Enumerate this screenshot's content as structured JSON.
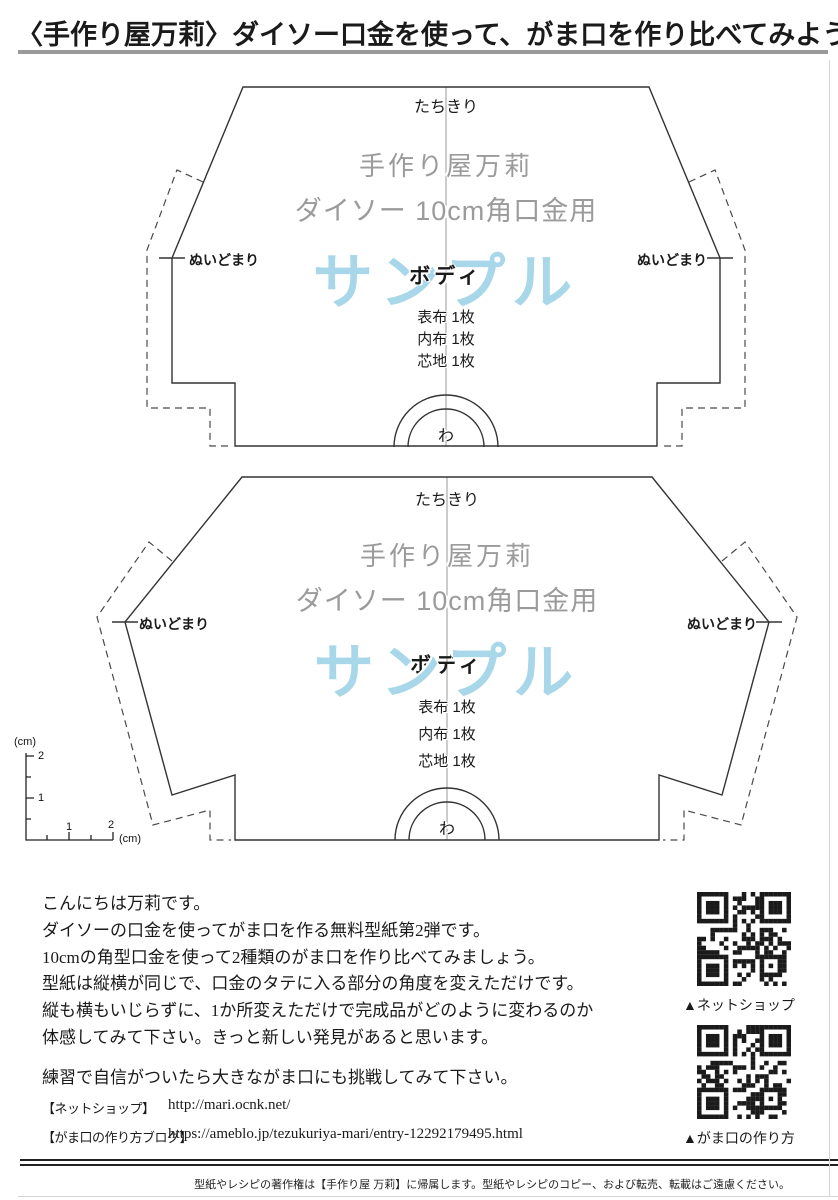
{
  "page": {
    "title": "〈手作り屋万莉〉ダイソー口金を使って、がま口を作り比べてみよう",
    "footer": "型紙やレシピの著作権は【手作り屋 万莉】に帰属します。型紙やレシピのコピー、および転売、転載はご遠慮ください。"
  },
  "colors": {
    "watermark_blue": "#a8d7ea",
    "gray_text": "#9b9b9b",
    "outline": "#333333"
  },
  "patterns": [
    {
      "cut_label": "たちきり",
      "brand": "手作り屋万莉",
      "frame": "ダイソー 10cm角口金用",
      "watermark": "サンプル",
      "piece": "ボディ",
      "materials": [
        "表布 1枚",
        "内布 1枚",
        "芯地 1枚"
      ],
      "fold_label": "わ",
      "seam_stop_left": "ぬいどまり",
      "seam_stop_right": "ぬいどまり"
    },
    {
      "cut_label": "たちきり",
      "brand": "手作り屋万莉",
      "frame": "ダイソー 10cm角口金用",
      "watermark": "サンプル",
      "piece": "ボディ",
      "materials": [
        "表布 1枚",
        "内布 1枚",
        "芯地 1枚"
      ],
      "fold_label": "わ",
      "seam_stop_left": "ぬいどまり",
      "seam_stop_right": "ぬいどまり"
    }
  ],
  "ruler": {
    "unit_vertical": "(cm)",
    "unit_horizontal": "(cm)",
    "v_label_2": "2",
    "v_label_1": "1",
    "h_label_1": "1",
    "h_label_2": "2"
  },
  "intro": [
    "こんにちは万莉です。",
    "ダイソーの口金を使ってがま口を作る無料型紙第2弾です。",
    "10cmの角型口金を使って2種類のがま口を作り比べてみましょう。",
    "型紙は縦横が同じで、口金のタテに入る部分の角度を変えただけです。",
    "縦も横もいじらずに、1か所変えただけで完成品がどのように変わるのか",
    "体感してみて下さい。きっと新しい発見があると思います。"
  ],
  "practice_line": "練習で自信がついたら大きながま口にも挑戦してみて下さい。",
  "links": [
    {
      "label": "【ネットショップ】",
      "url": "http://mari.ocnk.net/"
    },
    {
      "label": "【がま口の作り方ブログ】",
      "url": "https://ameblo.jp/tezukuriya-mari/entry-12292179495.html"
    }
  ],
  "qr": [
    {
      "caption": "▲ネットショップ"
    },
    {
      "caption": "▲がま口の作り方"
    }
  ]
}
